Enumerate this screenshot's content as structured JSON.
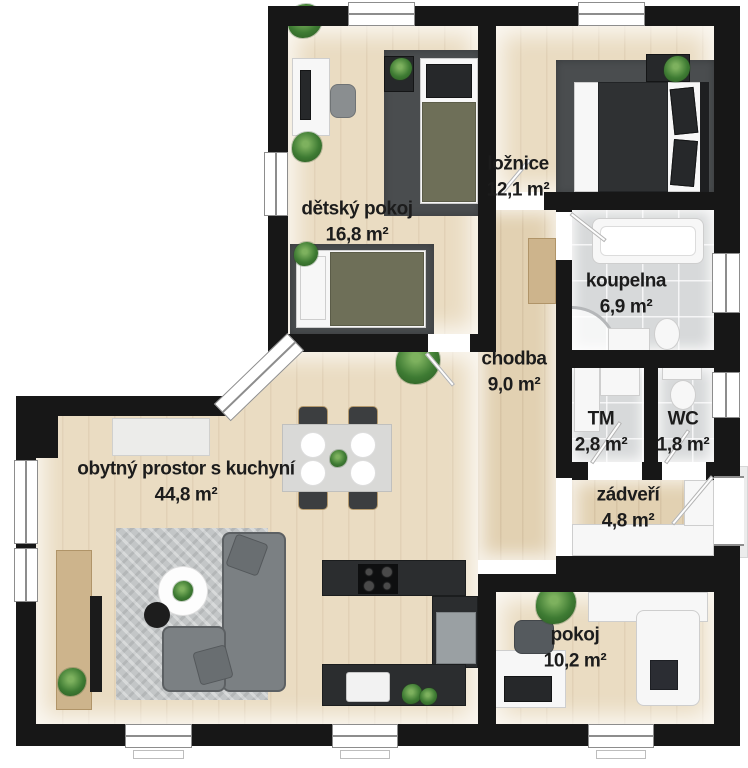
{
  "plan": {
    "title": "Floor plan of a family house (Czech labels)",
    "rooms": [
      {
        "id": "detsky-pokoj",
        "name": "dětský pokoj",
        "area": "16,8 m²"
      },
      {
        "id": "loznice",
        "name": "ložnice",
        "area": "12,1 m²"
      },
      {
        "id": "koupelna",
        "name": "koupelna",
        "area": "6,9 m²"
      },
      {
        "id": "chodba",
        "name": "chodba",
        "area": "9,0 m²"
      },
      {
        "id": "tm",
        "name": "TM",
        "area": "2,8 m²"
      },
      {
        "id": "wc",
        "name": "WC",
        "area": "1,8 m²"
      },
      {
        "id": "zadveri",
        "name": "zádveří",
        "area": "4,8 m²"
      },
      {
        "id": "obytny-prostor",
        "name": "obytný prostor s kuchyní",
        "area": "44,8 m²"
      },
      {
        "id": "pokoj",
        "name": "pokoj",
        "area": "10,2 m²"
      }
    ],
    "colors": {
      "wall": "#171717",
      "floor_wood": "#eadcc2",
      "floor_wood_dark": "#e2d1b2",
      "floor_tile": "#d7d9da",
      "rug_dark": "#4a4d4f",
      "rug_light": "#c3c6c7",
      "sofa": "#7b8083",
      "counter": "#2b2d2f",
      "furniture_white": "#f7f7f7",
      "wood_furniture": "#cdb48c",
      "plant": "#3e7b33",
      "label_text": "#1c1c1c"
    }
  }
}
